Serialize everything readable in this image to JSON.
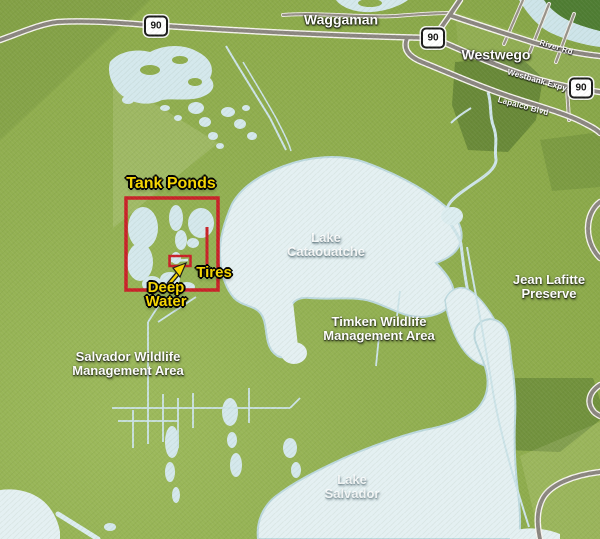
{
  "map": {
    "towns": [
      {
        "name": "Waggaman"
      },
      {
        "name": "Westwego"
      }
    ],
    "highway_shield": "90",
    "roads": [
      {
        "name": "River Rd"
      },
      {
        "name": "Westbank Expy"
      },
      {
        "name": "Lapalco Blvd"
      }
    ],
    "lakes": [
      {
        "name": "Lake Cataouatche",
        "lines": [
          "Lake",
          "Cataouatche"
        ]
      },
      {
        "name": "Lake Salvador",
        "lines": [
          "Lake",
          "Salvador"
        ]
      }
    ],
    "areas": [
      {
        "name": "Salvador Wildlife Management Area",
        "lines": [
          "Salvador Wildlife",
          "Management Area"
        ]
      },
      {
        "name": "Timken Wildlife Management Area",
        "lines": [
          "Timken Wildlife",
          "Management Area"
        ]
      },
      {
        "name": "Jean Lafitte Preserve",
        "lines": [
          "Jean Lafitte",
          "Preserve"
        ]
      }
    ],
    "annotations": [
      {
        "label": "Tank Ponds"
      },
      {
        "label": "Deep Water",
        "lines": [
          "Deep",
          "Water"
        ]
      },
      {
        "label": "Tires"
      }
    ],
    "colors": {
      "land_green": "#8fae4e",
      "water": "#e4f0f2",
      "road_gray": "#8b8680",
      "annotation_red": "#c92128",
      "label_yellow": "#f7d600"
    }
  }
}
